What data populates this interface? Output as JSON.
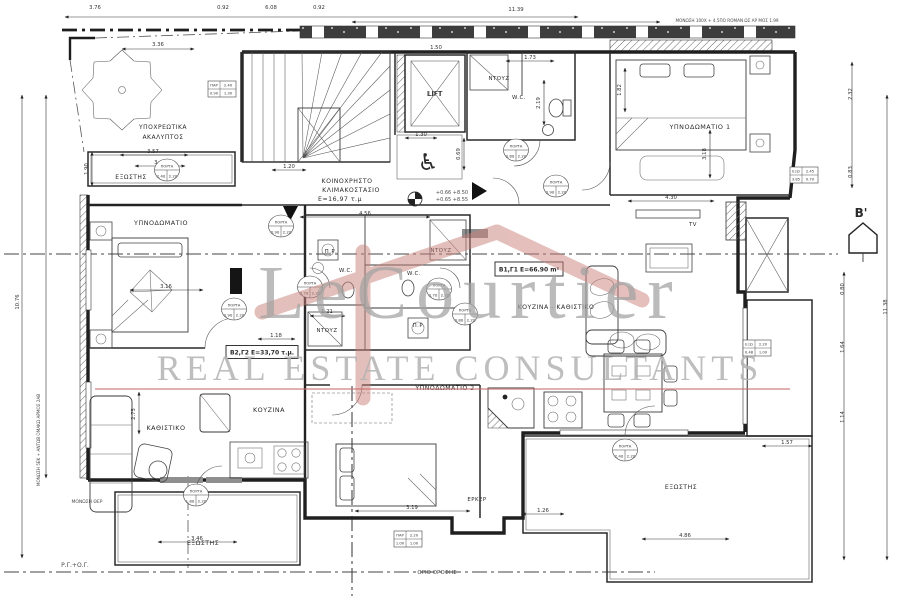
{
  "meta": {
    "drawing_kind": "apartment floor plan",
    "language": "Greek"
  },
  "watermark": {
    "brand": "LeCourtier",
    "subtitle": "REAL ESTATE CONSULTANTS",
    "brand_color": "#a2a2a2",
    "roof_color": "#c9807a",
    "line_color": "#c96a6a"
  },
  "section_marker": {
    "label": "B'"
  },
  "icons": {
    "wheelchair": "♿"
  },
  "door_tag_word": "ΠΟΡΤΑ",
  "plan": {
    "rooms": [
      {
        "t": "ΥΠΟΧΡΕΩΤΙΚΑ",
        "x": 163,
        "y": 129,
        "fs": 6
      },
      {
        "t": "ΑΚΑΛΥΠΤΟΣ",
        "x": 163,
        "y": 139,
        "fs": 6
      },
      {
        "t": "ΕΞΩΣΤΗΣ",
        "x": 131,
        "y": 179,
        "fs": 6
      },
      {
        "t": "ΚΟΙΝΟΧΡΗΣΤΟ",
        "x": 347,
        "y": 183,
        "fs": 6.2
      },
      {
        "t": "ΚΛΙΜΑΚΟΣΤΑΣΙΟ",
        "x": 351,
        "y": 192,
        "fs": 6.2
      },
      {
        "t": "Ε=16,97 τ.μ",
        "x": 340,
        "y": 201,
        "fs": 6.2
      },
      {
        "t": "LIFT",
        "x": 435,
        "y": 96,
        "fs": 7
      },
      {
        "t": "ΝΤΟΥΖ",
        "x": 499,
        "y": 80,
        "fs": 5.4
      },
      {
        "t": "W.C.",
        "x": 519,
        "y": 99,
        "fs": 5.4
      },
      {
        "t": "ΥΠΝΟΔΩΜΑΤΙΟ 1",
        "x": 700,
        "y": 129,
        "fs": 6.4
      },
      {
        "t": "ΥΠΝΟΔΩΜΑΤΙΟ",
        "x": 161,
        "y": 225,
        "fs": 6.4
      },
      {
        "t": "Π.Ρ.",
        "x": 331,
        "y": 253,
        "fs": 5.4
      },
      {
        "t": "W.C.",
        "x": 346,
        "y": 272,
        "fs": 5.4
      },
      {
        "t": "ΝΤΟΥΖ",
        "x": 441,
        "y": 252,
        "fs": 5.4
      },
      {
        "t": "W.C.",
        "x": 414,
        "y": 275,
        "fs": 5.4
      },
      {
        "t": "ΝΤΟΥΖ",
        "x": 327,
        "y": 332,
        "fs": 5.4
      },
      {
        "t": "Π.Ρ.",
        "x": 419,
        "y": 327,
        "fs": 5.4
      },
      {
        "t": "ΚΟΥΖΙΝΑ - ΚΑΘΙΣΤΙΚΟ",
        "x": 556,
        "y": 309,
        "fs": 6.2
      },
      {
        "t": "TV",
        "x": 693,
        "y": 226,
        "fs": 5.4
      },
      {
        "t": "ΚΑΘΙΣΤΙΚΟ",
        "x": 166,
        "y": 430,
        "fs": 6.4
      },
      {
        "t": "ΚΟΥΖΙΝΑ",
        "x": 269,
        "y": 412,
        "fs": 6.4
      },
      {
        "t": "ΥΠΝΟΔΩΜΑΤΙΟ 2",
        "x": 445,
        "y": 390,
        "fs": 6.2
      },
      {
        "t": "ΕΡΚΕΡ",
        "x": 477,
        "y": 501,
        "fs": 5.4
      },
      {
        "t": "ΕΞΩΣΤΗΣ",
        "x": 203,
        "y": 545,
        "fs": 6.2
      },
      {
        "t": "ΕΞΩΣΤΗΣ",
        "x": 681,
        "y": 489,
        "fs": 6.2
      }
    ],
    "unit_tags": [
      {
        "label": "Β2,Γ2 Ε=33,70 τ.μ.",
        "x": 262,
        "y": 352,
        "w": 72,
        "h": 13
      },
      {
        "label": "Β1,Γ1 Ε=66.90 m²",
        "x": 529,
        "y": 269,
        "w": 68,
        "h": 14
      }
    ],
    "dimensions": [
      {
        "t": "3.76",
        "x": 95,
        "y": 9
      },
      {
        "t": "0.92",
        "x": 223,
        "y": 9
      },
      {
        "t": "6.08",
        "x": 271,
        "y": 9
      },
      {
        "t": "0.92",
        "x": 319,
        "y": 9
      },
      {
        "t": "11.39",
        "x": 516,
        "y": 11
      },
      {
        "t": "3.36",
        "x": 158,
        "y": 46
      },
      {
        "t": "1.50",
        "x": 436,
        "y": 49
      },
      {
        "t": "1.73",
        "x": 530,
        "y": 59
      },
      {
        "t": "2.19",
        "x": 540,
        "y": 103,
        "rot": -90
      },
      {
        "t": "1.82",
        "x": 621,
        "y": 90,
        "rot": -90
      },
      {
        "t": "2.32",
        "x": 852,
        "y": 94,
        "rot": -90
      },
      {
        "t": "0.83",
        "x": 852,
        "y": 172,
        "rot": -90
      },
      {
        "t": "1.30",
        "x": 421,
        "y": 136
      },
      {
        "t": "0.69",
        "x": 460,
        "y": 154,
        "rot": -90
      },
      {
        "t": "1.20",
        "x": 289,
        "y": 168
      },
      {
        "t": "3.57",
        "x": 153,
        "y": 153
      },
      {
        "t": "3.42",
        "x": 160,
        "y": 164
      },
      {
        "t": "1.90",
        "x": 88,
        "y": 169,
        "rot": -90
      },
      {
        "t": "4.56",
        "x": 365,
        "y": 215
      },
      {
        "t": "4.30",
        "x": 671,
        "y": 199
      },
      {
        "t": "3.18",
        "x": 706,
        "y": 154,
        "rot": -90
      },
      {
        "t": "3.16",
        "x": 166,
        "y": 288
      },
      {
        "t": "1.18",
        "x": 276,
        "y": 337
      },
      {
        "t": "1.21",
        "x": 327,
        "y": 313
      },
      {
        "t": "2.75",
        "x": 135,
        "y": 414,
        "rot": -90
      },
      {
        "t": "3.19",
        "x": 412,
        "y": 509
      },
      {
        "t": "1.26",
        "x": 543,
        "y": 512
      },
      {
        "t": "3.46",
        "x": 197,
        "y": 540
      },
      {
        "t": "4.86",
        "x": 685,
        "y": 537
      },
      {
        "t": "1.57",
        "x": 787,
        "y": 444
      },
      {
        "t": "0.80",
        "x": 844,
        "y": 289,
        "rot": -90
      },
      {
        "t": "1.64",
        "x": 844,
        "y": 347,
        "rot": -90
      },
      {
        "t": "1.14",
        "x": 844,
        "y": 417,
        "rot": -90
      },
      {
        "t": "11.38",
        "x": 887,
        "y": 307,
        "rot": -90
      },
      {
        "t": "10.76",
        "x": 19,
        "y": 302,
        "rot": -90
      }
    ],
    "notes": [
      {
        "t": "ΜΟΝΩΣΗ 100Χ + 4.5ΠΟ ROMAN ΩΣ ΑΡ ΜΟΣ 1.99",
        "x": 727,
        "y": 22,
        "fs": 4.2
      },
      {
        "t": "ΜΟΝΩΣΗ 5ΕΚ + ΑΝΤΩΒ ΟΜΑΚΩ ΑΡΜΟΣ 2ΑΒ",
        "x": 40,
        "y": 440,
        "fs": 4.2,
        "rot": -90
      },
      {
        "t": "ΜΟΝΩΣΗ ΘΕΡ",
        "x": 87,
        "y": 503,
        "fs": 4.5
      },
      {
        "t": "Ρ.Γ.+Ο.Γ.",
        "x": 75,
        "y": 567,
        "fs": 6
      },
      {
        "t": "ΟΡΙΟ ΟΡΟΦΗΣ",
        "x": 437,
        "y": 574,
        "fs": 5.5
      },
      {
        "t": "+0.66 +8.50",
        "x": 452,
        "y": 194,
        "fs": 5
      },
      {
        "t": "+0.65 +8.55",
        "x": 452,
        "y": 201,
        "fs": 5
      }
    ],
    "door_tags": [
      {
        "x": 167,
        "y": 170,
        "a": "2.40",
        "b": "2.20"
      },
      {
        "x": 516,
        "y": 150,
        "a": "0.80",
        "b": "2.20"
      },
      {
        "x": 556,
        "y": 186,
        "a": "0.90",
        "b": "2.20"
      },
      {
        "x": 281,
        "y": 226,
        "a": "0.90",
        "b": "2.20"
      },
      {
        "x": 234,
        "y": 309,
        "a": "0.90",
        "b": "2.20"
      },
      {
        "x": 310,
        "y": 287,
        "a": "0.70",
        "b": "2.20"
      },
      {
        "x": 439,
        "y": 289,
        "a": "0.70",
        "b": "2.20"
      },
      {
        "x": 465,
        "y": 314,
        "a": "0.80",
        "b": "2.20"
      },
      {
        "x": 196,
        "y": 495,
        "a": "1.80",
        "b": "2.20"
      },
      {
        "x": 625,
        "y": 450,
        "a": "2.40",
        "b": "2.20"
      }
    ],
    "window_tags": [
      {
        "x": 222,
        "y": 89,
        "c11": "ΠΑΡ",
        "c12": "2.40",
        "c21": "0.90",
        "c22": "1.30"
      },
      {
        "x": 804,
        "y": 175,
        "c11": "ΕΞΩ",
        "c12": "2.45",
        "c21": "3.85",
        "c22": "0.70"
      },
      {
        "x": 757,
        "y": 348,
        "c11": "ΕΞΩ",
        "c12": "2.20",
        "c21": "0.48",
        "c22": "1.00"
      },
      {
        "x": 408,
        "y": 539,
        "c11": "ΠΑΡ",
        "c12": "2.20",
        "c21": "1.00",
        "c22": "1.00"
      }
    ]
  }
}
